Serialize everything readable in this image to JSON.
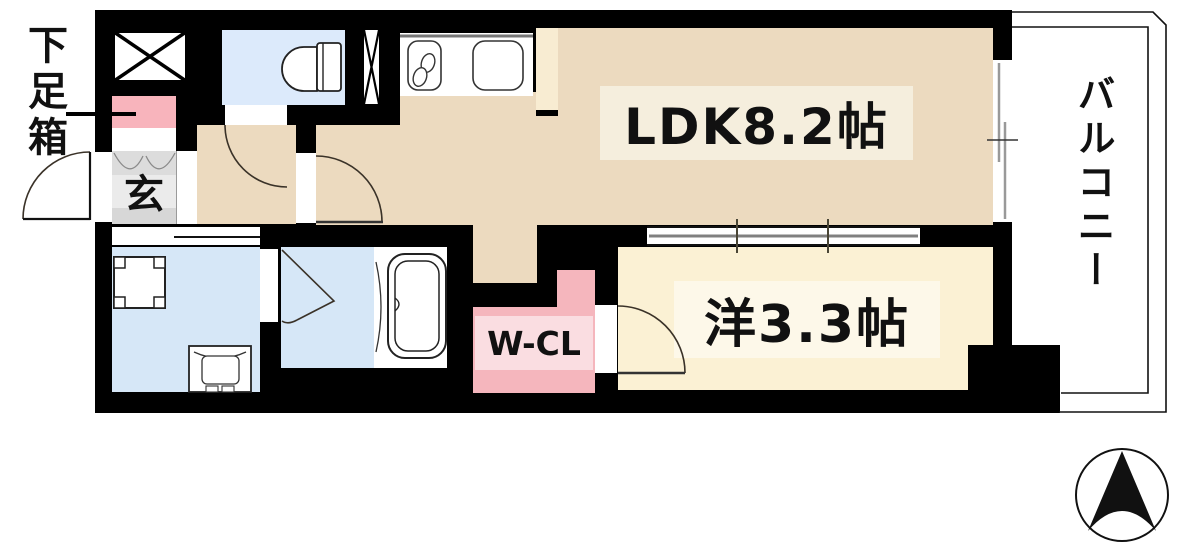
{
  "figure": {
    "type": "floor-plan",
    "rooms": {
      "ldk": {
        "label": "LDK8.2帖"
      },
      "western_room": {
        "label": "洋3.3帖"
      },
      "walk_in_closet": {
        "label": "W-CL"
      },
      "genkan": {
        "label": "玄"
      },
      "balcony": {
        "label": "バルコニー"
      }
    },
    "annotations": {
      "shoe_box_label": "下足箱"
    },
    "fixtures": [
      "elevator-shaft-x",
      "pipe-space-x",
      "toilet",
      "kitchen-counter",
      "gas-stove",
      "kitchen-sink",
      "refrigerator-space",
      "washing-machine-pan",
      "vanity-basin",
      "bathtub",
      "sliding-partition",
      "balcony-window",
      "north-compass"
    ],
    "colors": {
      "wall": "#000000",
      "ldk_floor": "#ecdabf",
      "western_floor": "#fbf1d4",
      "wet_area_floor": "#d6e7f7",
      "toilet_floor": "#dceafb",
      "closet_pink": "#f5b6bd",
      "closet_label_bg": "#fadde1",
      "shoe_box_pink": "#f8b4bc",
      "genkan_gray": "#ebebeb",
      "pillar_cream": "#f8ecd2",
      "ldk_label_bg": "#f5eedd",
      "western_label_bg": "#fdf8e9",
      "balcony_bg": "#ffffff"
    }
  }
}
